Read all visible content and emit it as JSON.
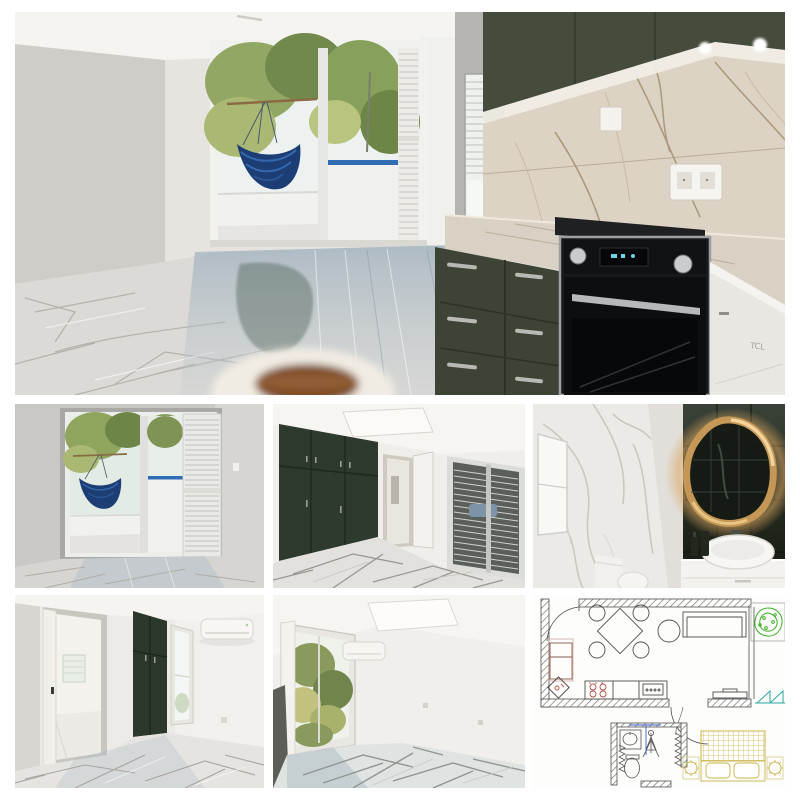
{
  "window": {
    "width": 800,
    "height": 800,
    "background": "#ffffff"
  },
  "collage": {
    "tiles": [
      {
        "id": "living-kitchen",
        "semantic": "open-plan-living-room-and-kitchen-photo"
      },
      {
        "id": "balcony-room",
        "semantic": "room-with-balcony-door-and-hammock-photo"
      },
      {
        "id": "wardrobe-bedroom",
        "semantic": "bedroom-with-green-fitted-wardrobe-photo"
      },
      {
        "id": "bathroom",
        "semantic": "bathroom-with-backlit-mirror-photo"
      },
      {
        "id": "bedroom-ac",
        "semantic": "bedroom-with-hall-door-and-air-conditioner-photo"
      },
      {
        "id": "window-room",
        "semantic": "room-with-open-window-and-air-conditioner-photo"
      },
      {
        "id": "floor-plan",
        "semantic": "apartment-floor-plan-drawing"
      }
    ]
  },
  "kitchen": {
    "appliance_brand": "TCL"
  },
  "floor_plan_symbols": [
    "dining-table",
    "dining-chairs",
    "sofa",
    "round-table",
    "balcony-plant",
    "fridge",
    "corner-sink",
    "cooktop",
    "kitchen-counter",
    "tv-bench",
    "balcony-folding-door",
    "bathroom-sink",
    "shower",
    "toilet",
    "double-bed",
    "pillows",
    "nightstand-lamps"
  ],
  "palette": {
    "background": "#ffffff",
    "wall_light": "#e7e4df",
    "wall_shadow": "#cfccc7",
    "ceiling": "#f6f4f0",
    "cabinet_olive": "#454c3c",
    "cabinet_olive_dark": "#333a2d",
    "wardrobe_green": "#2e3a2d",
    "hammock_blue": "#1c3e74",
    "hammock_stripe": "#3568ae",
    "rail_blue": "#2f6cb3",
    "tree_green": "#7e9455",
    "marble_floor": "#dcdad6",
    "marble_vein": "#b0aca6",
    "floor_reflection": "#9fb3c0",
    "backsplash": "#ddd3c5",
    "backsplash_vein": "#a5906f",
    "oven_black": "#141619",
    "steel": "#a8abad",
    "appliance_white": "#eceae5",
    "bath_wall_dark": "#23291f",
    "mirror_glow": "#d9a660",
    "plan_line": "#4f4f4f",
    "plan_hatch": "#77776f",
    "plan_green": "#3fae2a",
    "plan_tan": "#c9b44a",
    "plan_teal": "#2ba8a2",
    "plan_red": "#b05048",
    "plan_blue": "#3a5fc4"
  }
}
